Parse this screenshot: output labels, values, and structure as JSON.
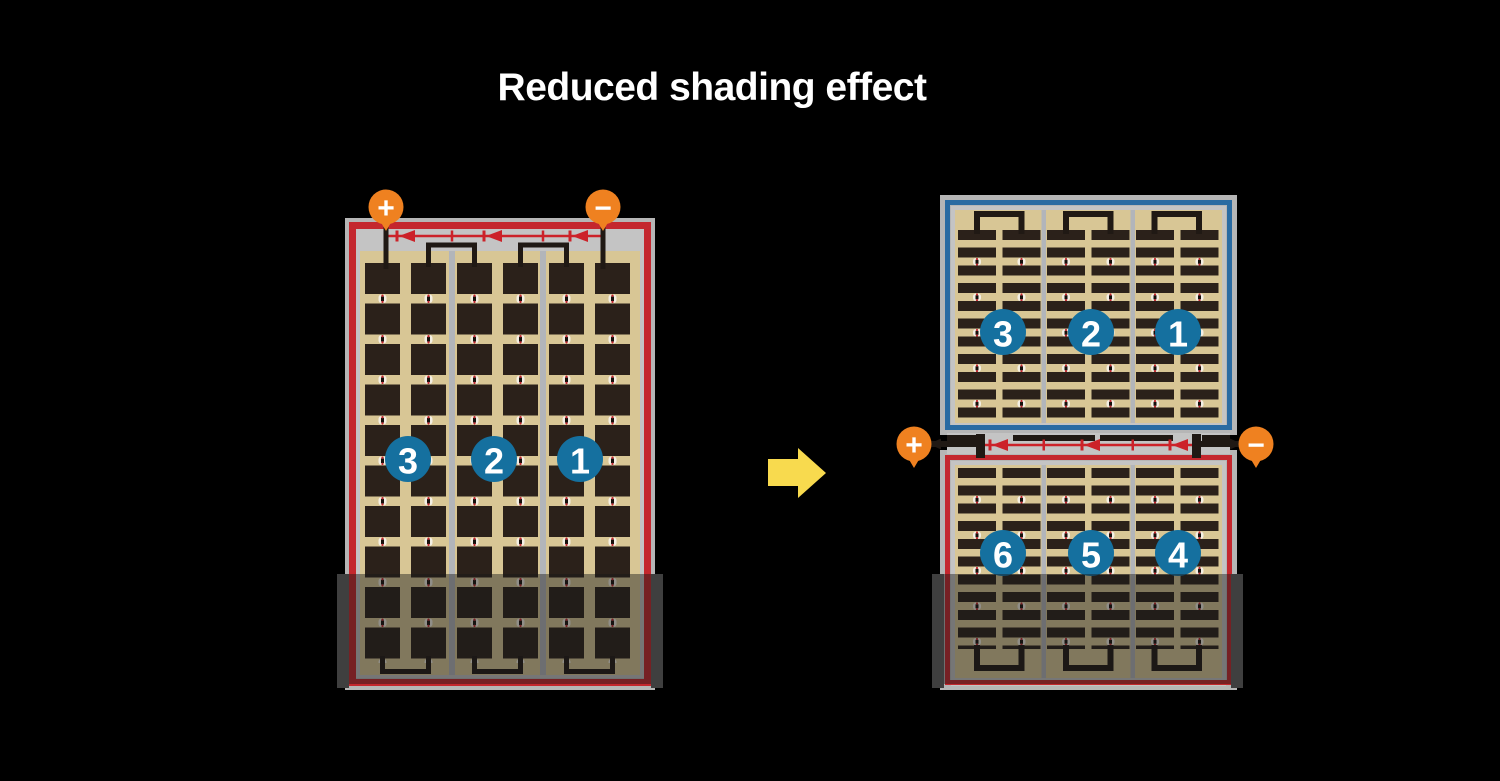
{
  "title": "Reduced shading effect",
  "colors": {
    "background": "#000000",
    "terminal_orange": "#ef8120",
    "module_red": "#c4272e",
    "module_blue": "#2a6ba2",
    "circle_blue": "#15709f",
    "cell_dark": "#2b211a",
    "cell_tan": "#d8c695",
    "frame_gray": "#b6b6b6",
    "inner_gray": "#c4c4c4",
    "divider_gray": "#b2b5ba",
    "diode_red": "#cc2229",
    "wire_black": "#201914",
    "arrow_yellow": "#f8da4e",
    "shade": "rgba(25,25,25,0.45)",
    "shade_edge": "#3f3f3f"
  },
  "left_module": {
    "label_positive": "+",
    "label_negative": "−",
    "strings": [
      {
        "number": "3"
      },
      {
        "number": "2"
      },
      {
        "number": "1"
      }
    ]
  },
  "right_module": {
    "label_positive": "+",
    "label_negative": "−",
    "top_strings": [
      {
        "number": "3"
      },
      {
        "number": "2"
      },
      {
        "number": "1"
      }
    ],
    "bottom_strings": [
      {
        "number": "6"
      },
      {
        "number": "5"
      },
      {
        "number": "4"
      }
    ]
  }
}
